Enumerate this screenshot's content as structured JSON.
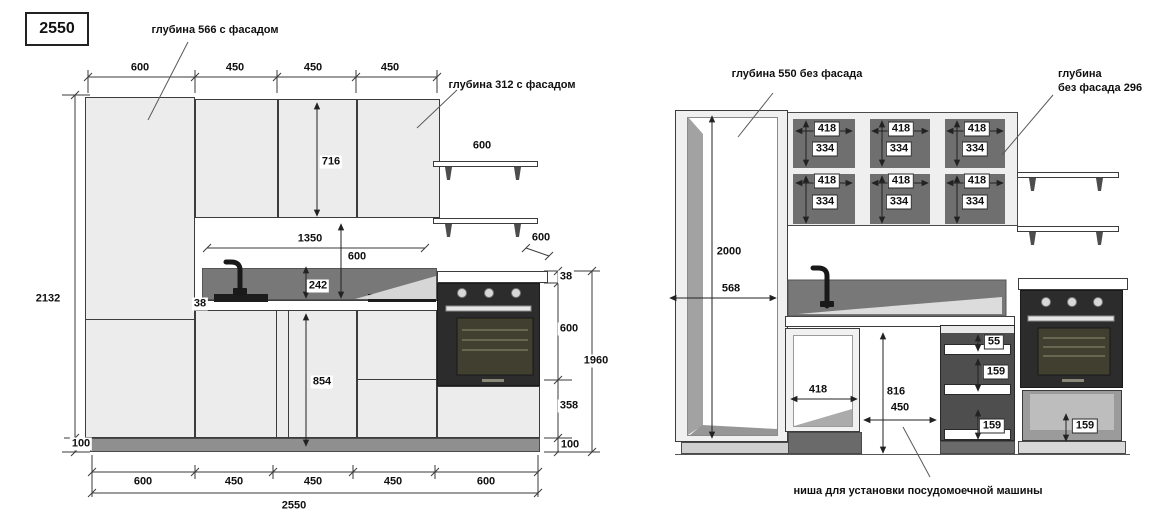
{
  "page": {
    "total_width_label": "2550"
  },
  "notes": {
    "depth_with_facade_tall": "глубина 566 с фасадом",
    "depth_with_facade_wall": "глубина 312 с фасадом",
    "depth_no_facade_tall": "глубина 550 без фасада",
    "depth_no_facade_wall_line1": "глубина",
    "depth_no_facade_wall_line2": "без фасада 296",
    "dishwasher_niche": "ниша для установки посудомоечной машины"
  },
  "left_view": {
    "top_dims": [
      "600",
      "450",
      "450",
      "450"
    ],
    "wall_cabinet_height": "716",
    "shelf_width": "600",
    "counter_depth": "600",
    "counter_thickness_left": "38",
    "opening_width": "1350",
    "apron_height": "600",
    "backsplash_height": "242",
    "base_height": "854",
    "total_height": "2132",
    "plinth_height_left": "100",
    "right_chain": {
      "counter_thickness": "38",
      "oven_height": "600",
      "drawer_height": "358",
      "plinth_height": "100",
      "total": "1960"
    },
    "bottom_dims": [
      "600",
      "450",
      "450",
      "450",
      "600"
    ],
    "bottom_total": "2550"
  },
  "right_view": {
    "tall_interior_height": "2000",
    "tall_interior_width": "568",
    "wall_sections": [
      {
        "top_width": "418",
        "top_height": "334",
        "bottom_width": "418",
        "bottom_height": "334"
      },
      {
        "top_width": "418",
        "top_height": "334",
        "bottom_width": "418",
        "bottom_height": "334"
      },
      {
        "top_width": "418",
        "top_height": "334",
        "bottom_width": "418",
        "bottom_height": "334"
      }
    ],
    "sink_cabinet_width": "418",
    "niche_height": "816",
    "niche_width": "450",
    "drawer_dims": [
      "55",
      "159",
      "159"
    ],
    "oven_drawer_height": "159"
  },
  "colors": {
    "line": "#3c3c3c",
    "face": "#ececec",
    "dark_panel": "#787878",
    "oven": "#2c2c2c"
  }
}
